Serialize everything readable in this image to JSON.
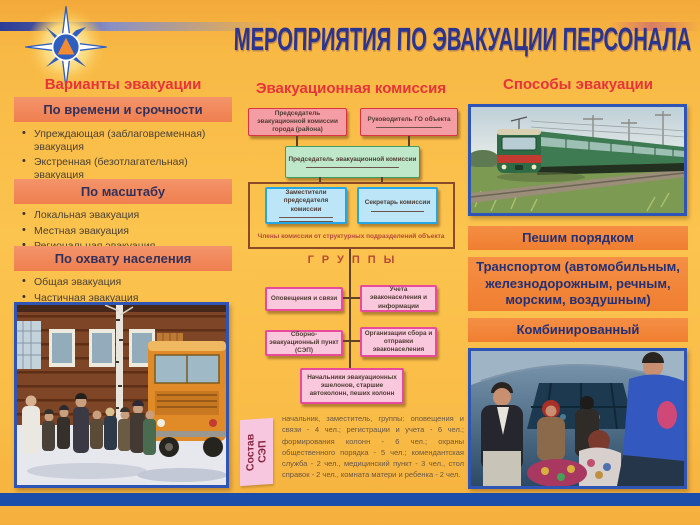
{
  "title": "МЕРОПРИЯТИЯ ПО ЭВАКУАЦИИ ПЕРСОНАЛА",
  "left_column": {
    "heading": "Варианты эвакуации",
    "sections": [
      {
        "band": "По времени и срочности",
        "items": [
          "Упреждающая (заблаговременная) эвакуация",
          "Экстренная (безотлагательная) эвакуация"
        ]
      },
      {
        "band": "По масштабу",
        "items": [
          "Локальная эвакуация",
          "Местная эвакуация",
          "Региональная эвакуация"
        ]
      },
      {
        "band": "По охвату населения",
        "items": [
          "Общая эвакуация",
          "Частичная эвакуация"
        ]
      }
    ]
  },
  "center_column": {
    "heading": "Эвакуационная комиссия",
    "org_chart": {
      "city_commission_chair": "Председатель эвакуационной комиссии города (района)",
      "go_object_head": "Руководитель ГО объекта",
      "commission_chair": "Председатель эвакуационной комиссии",
      "deputies": "Заместители председателя комиссии",
      "secretary": "Секретарь комиссии",
      "members_note": "Члены комиссии от структурных подразделений объекта",
      "groups_label": "ГРУППЫ",
      "groups": [
        "Оповещения и связи",
        "Учета эваконаселения и информации",
        "Сборно-эвакуационный пункт (СЭП)",
        "Организации сбора и отправки эваконаселения"
      ],
      "train_chiefs": "Начальники эвакуационных эшелонов, старшие автоколонн, пеших колонн"
    },
    "sep": {
      "label": "Состав СЭП",
      "text": "начальник, заместитель, группы: оповещения и связи - 4 чел.; регистрации и учета - 6 чел.; формирования колонн - 6 чел.; охраны общественного порядка - 5 чел.; комендантская служба - 2 чел., медицинский пункт - 3 чел., стол справок - 2 чел., комната матери и ребенка - 2 чел."
    }
  },
  "right_column": {
    "heading": "Способы эвакуации",
    "methods": [
      "Пешим порядком",
      "Транспортом (автомобильным, железнодорожным, речным, морским, воздушным)",
      "Комбинированный"
    ]
  },
  "colors": {
    "background": "#F9BC47",
    "title_blue": "#2B3590",
    "heading_red": "#E8333A",
    "band_left": "#F1875C",
    "band_right": "#F28539",
    "pink_box": "#F59DA5",
    "pink_box_border": "#D93440",
    "green_box": "#BFE7C9",
    "blue_box": "#BCE6F8",
    "group_box": "#F9C8DC",
    "group_box_border": "#E84A9C",
    "footer_band": "#1B4DAB"
  }
}
